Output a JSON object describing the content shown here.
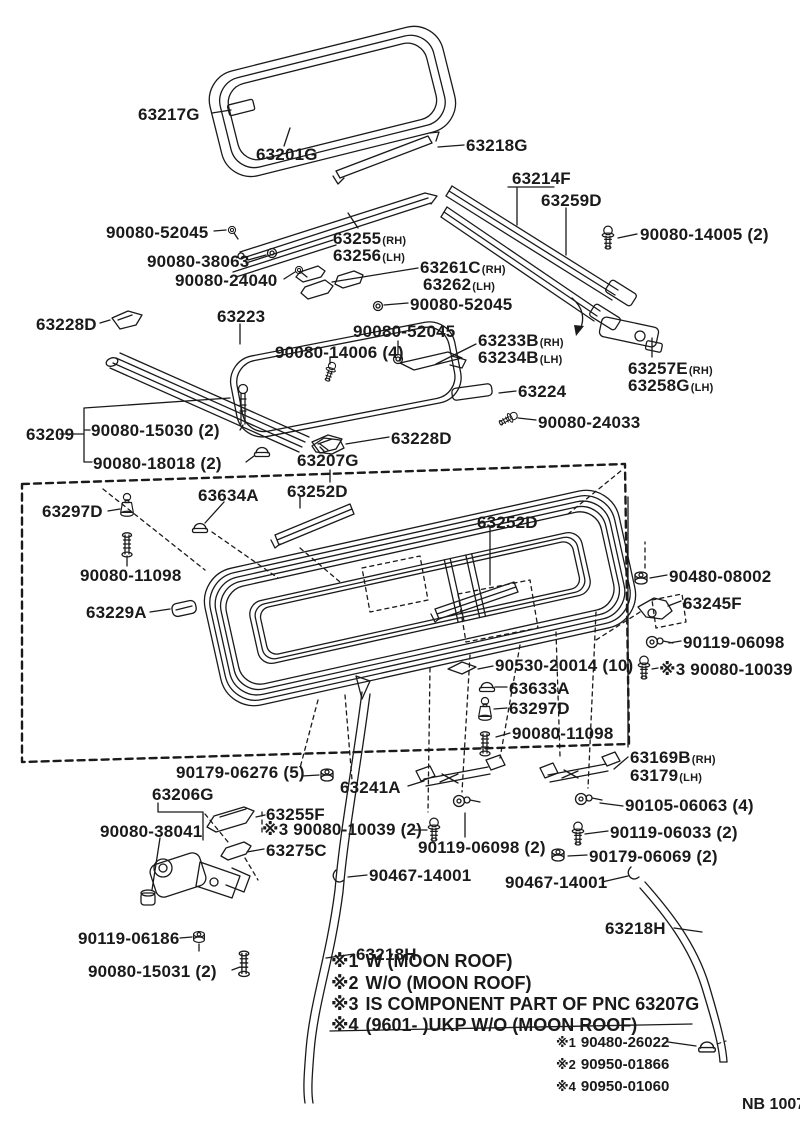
{
  "page": {
    "paper_color": "#ffffff",
    "ink_color": "#1a1a1a",
    "footer_code": "NB 1007"
  },
  "diagram": {
    "part_labels": [
      {
        "t": "63217G",
        "x": 138,
        "y": 106
      },
      {
        "t": "63201G",
        "x": 256,
        "y": 146
      },
      {
        "t": "63218G",
        "x": 466,
        "y": 137
      },
      {
        "t": "63214F",
        "x": 512,
        "y": 170
      },
      {
        "t": "63259D",
        "x": 541,
        "y": 192
      },
      {
        "t": "90080-52045",
        "x": 106,
        "y": 224
      },
      {
        "t": "63255",
        "s": "(RH)",
        "x": 333,
        "y": 230
      },
      {
        "t": "63256",
        "s": "(LH)",
        "x": 333,
        "y": 247
      },
      {
        "t": "90080-14005 (2)",
        "x": 640,
        "y": 226
      },
      {
        "t": "90080-38063",
        "x": 147,
        "y": 253
      },
      {
        "t": "63261C",
        "s": "(RH)",
        "x": 420,
        "y": 259
      },
      {
        "t": "63262",
        "s": "(LH)",
        "x": 423,
        "y": 276
      },
      {
        "t": "90080-24040",
        "x": 175,
        "y": 272
      },
      {
        "t": "90080-52045",
        "x": 410,
        "y": 296
      },
      {
        "t": "63228D",
        "x": 36,
        "y": 316
      },
      {
        "t": "63223",
        "x": 217,
        "y": 308
      },
      {
        "t": "90080-52045",
        "x": 353,
        "y": 323
      },
      {
        "t": "63233B",
        "s": "(RH)",
        "x": 478,
        "y": 332
      },
      {
        "t": "63234B",
        "s": "(LH)",
        "x": 478,
        "y": 349
      },
      {
        "t": "90080-14006 (4)",
        "x": 275,
        "y": 344
      },
      {
        "t": "63257E",
        "s": "(RH)",
        "x": 628,
        "y": 360
      },
      {
        "t": "63258G",
        "s": "(LH)",
        "x": 628,
        "y": 377
      },
      {
        "t": "63224",
        "x": 518,
        "y": 383
      },
      {
        "t": "90080-24033",
        "x": 538,
        "y": 414
      },
      {
        "t": "63209",
        "x": 26,
        "y": 426
      },
      {
        "t": "90080-15030 (2)",
        "x": 91,
        "y": 422
      },
      {
        "t": "63228D",
        "x": 391,
        "y": 430
      },
      {
        "t": "90080-18018 (2)",
        "x": 93,
        "y": 455
      },
      {
        "t": "63207G",
        "x": 297,
        "y": 452
      },
      {
        "t": "63297D",
        "x": 42,
        "y": 503
      },
      {
        "t": "63634A",
        "x": 198,
        "y": 487
      },
      {
        "t": "63252D",
        "x": 287,
        "y": 483
      },
      {
        "t": "63252D",
        "x": 477,
        "y": 514
      },
      {
        "t": "90080-11098",
        "x": 80,
        "y": 567
      },
      {
        "t": "90480-08002",
        "x": 669,
        "y": 568
      },
      {
        "t": "63229A",
        "x": 86,
        "y": 604
      },
      {
        "t": "63245F",
        "x": 683,
        "y": 595
      },
      {
        "t": "90119-06098",
        "x": 683,
        "y": 634
      },
      {
        "t": "90530-20014 (10)",
        "x": 495,
        "y": 657
      },
      {
        "t": "※3 90080-10039",
        "x": 659,
        "y": 661
      },
      {
        "t": "63633A",
        "x": 509,
        "y": 680
      },
      {
        "t": "63297D",
        "x": 509,
        "y": 700
      },
      {
        "t": "90080-11098",
        "x": 512,
        "y": 725
      },
      {
        "t": "63169B",
        "s": "(RH)",
        "x": 630,
        "y": 749
      },
      {
        "t": "63179",
        "s": "(LH)",
        "x": 630,
        "y": 767
      },
      {
        "t": "90179-06276 (5)",
        "x": 176,
        "y": 764
      },
      {
        "t": "63241A",
        "x": 340,
        "y": 779
      },
      {
        "t": "63206G",
        "x": 152,
        "y": 786
      },
      {
        "t": "63255F",
        "x": 266,
        "y": 806
      },
      {
        "t": "90080-38041",
        "x": 100,
        "y": 823
      },
      {
        "t": "※3 90080-10039 (2)",
        "x": 262,
        "y": 821
      },
      {
        "t": "63275C",
        "x": 266,
        "y": 842
      },
      {
        "t": "90105-06063 (4)",
        "x": 625,
        "y": 797
      },
      {
        "t": "90119-06098 (2)",
        "x": 418,
        "y": 839
      },
      {
        "t": "90119-06033 (2)",
        "x": 610,
        "y": 824
      },
      {
        "t": "90179-06069 (2)",
        "x": 589,
        "y": 848
      },
      {
        "t": "90467-14001",
        "x": 369,
        "y": 867
      },
      {
        "t": "90467-14001",
        "x": 505,
        "y": 874
      },
      {
        "t": "63218H",
        "x": 605,
        "y": 920
      },
      {
        "t": "90119-06186",
        "x": 78,
        "y": 930
      },
      {
        "t": "63218H",
        "x": 356,
        "y": 946
      },
      {
        "t": "90080-15031 (2)",
        "x": 88,
        "y": 963
      }
    ],
    "notes": [
      {
        "marker": "※1",
        "text": "W (MOON ROOF)",
        "x": 331,
        "y": 952
      },
      {
        "marker": "※2",
        "text": "W/O (MOON ROOF)",
        "x": 331,
        "y": 974
      },
      {
        "marker": "※3",
        "text": "IS COMPONENT PART OF PNC 63207G",
        "x": 331,
        "y": 995
      },
      {
        "marker": "※4",
        "text": "(9601-        )UKP W/O (MOON ROOF)",
        "x": 331,
        "y": 1016
      }
    ],
    "sub_notes": [
      {
        "marker": "※1",
        "text": "90480-26022",
        "x": 556,
        "y": 1035
      },
      {
        "marker": "※2",
        "text": "90950-01866",
        "x": 556,
        "y": 1057
      },
      {
        "marker": "※4",
        "text": "90950-01060",
        "x": 556,
        "y": 1079
      }
    ],
    "footer": {
      "text": "NB 1007",
      "x": 742,
      "y": 1097
    }
  }
}
